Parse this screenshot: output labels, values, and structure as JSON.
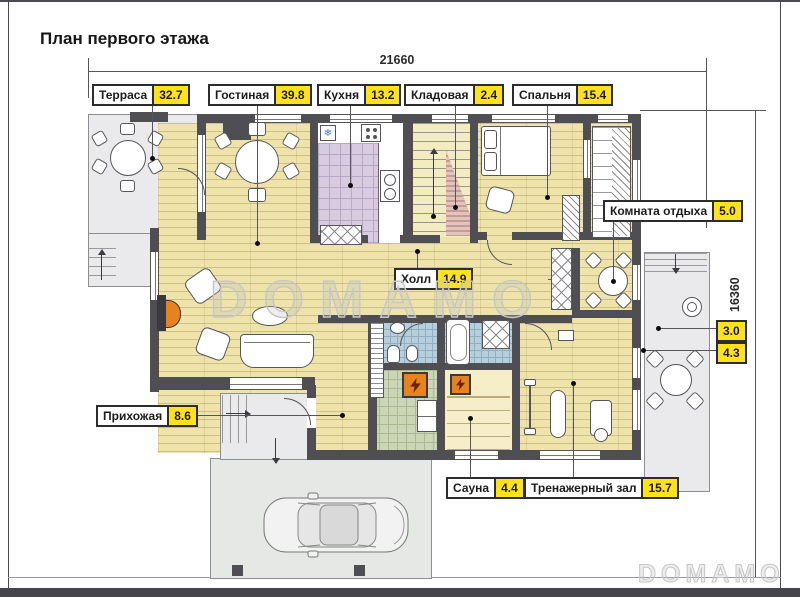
{
  "title": "План первого этажа",
  "dimensions": {
    "width_mm": "21660",
    "height_mm": "16360"
  },
  "rooms": {
    "terrace": {
      "name": "Терраса",
      "area": "32.7"
    },
    "living_room": {
      "name": "Гостиная",
      "area": "39.8"
    },
    "kitchen": {
      "name": "Кухня",
      "area": "13.2"
    },
    "storage": {
      "name": "Кладовая",
      "area": "2.4"
    },
    "bedroom": {
      "name": "Спальня",
      "area": "15.4"
    },
    "lounge": {
      "name": "Комната отдыха",
      "area": "5.0"
    },
    "hall": {
      "name": "Холл",
      "area": "14.9"
    },
    "wc": {
      "area": "3.0"
    },
    "bathroom": {
      "area": "4.3"
    },
    "entry_hall": {
      "name": "Прихожая",
      "area": "8.6"
    },
    "sauna": {
      "name": "Сауна",
      "area": "4.4"
    },
    "gym": {
      "name": "Тренажерный зал",
      "area": "15.7"
    }
  },
  "watermark": {
    "center": "DOMAMO",
    "corner": "DOMAMO"
  },
  "colors": {
    "accent_yellow": "#ffe21a",
    "wall": "#4e4e53",
    "heater_orange": "#e8821e"
  }
}
